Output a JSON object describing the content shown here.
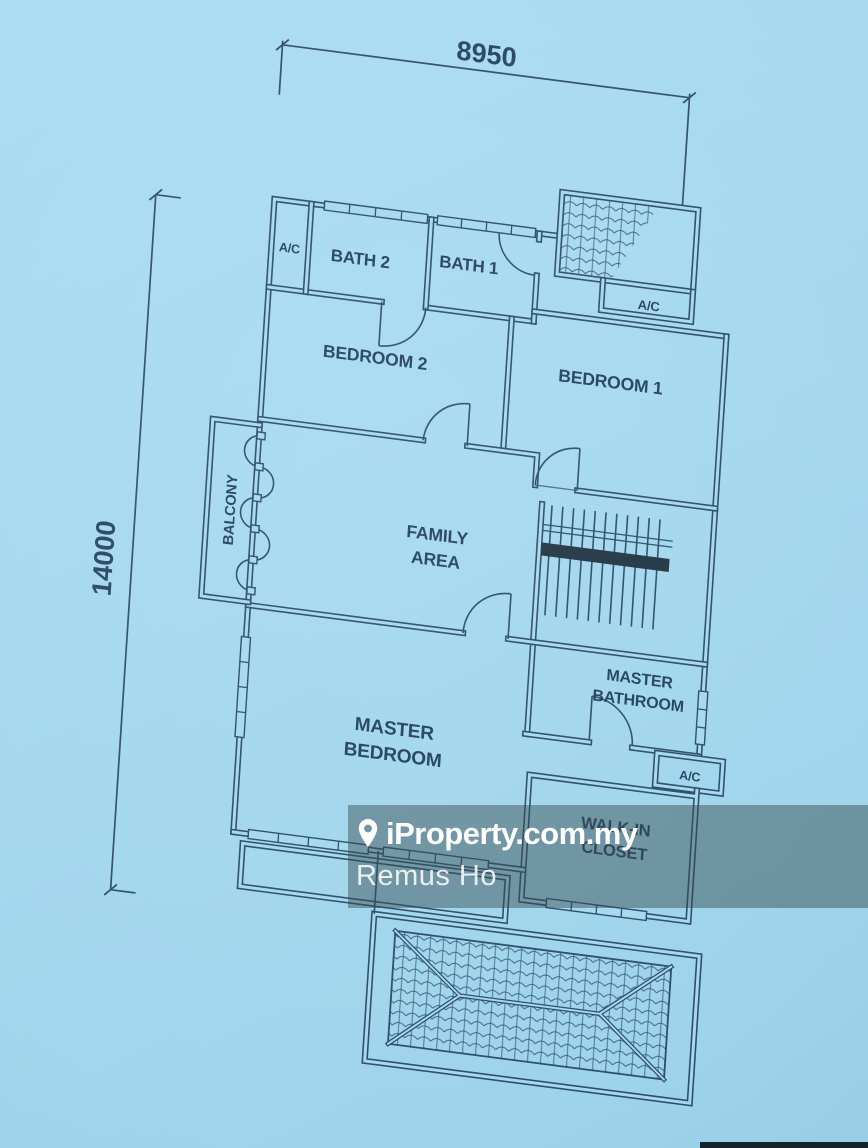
{
  "photo": {
    "background_color": "#a6d9ee",
    "line_color": "#2e4f6c",
    "text_color": "#1c3854",
    "description": "Blueprint floor plan photographed on light blue paper"
  },
  "dimensions": {
    "top_width": "8950",
    "left_height": "14000"
  },
  "rooms": {
    "ac_top_left": "A/C",
    "bath2": "BATH 2",
    "bath1": "BATH 1",
    "bedroom2": "BEDROOM 2",
    "bedroom1": "BEDROOM 1",
    "ac_top_right": "A/C",
    "balcony": "BALCONY",
    "family_line1": "FAMILY",
    "family_line2": "AREA",
    "master_bathroom_line1": "MASTER",
    "master_bathroom_line2": "BATHROOM",
    "master_bedroom_line1": "MASTER",
    "master_bedroom_line2": "BEDROOM",
    "ac_bottom_right": "A/C",
    "walk_in_closet_line1": "WALK-IN",
    "walk_in_closet_line2": "CLOSET"
  },
  "watermark": {
    "brand": "iProperty.com.my",
    "agent": "Remus Ho",
    "pin_icon": "location-pin",
    "band_color": "rgba(52,72,78,0.47)"
  }
}
